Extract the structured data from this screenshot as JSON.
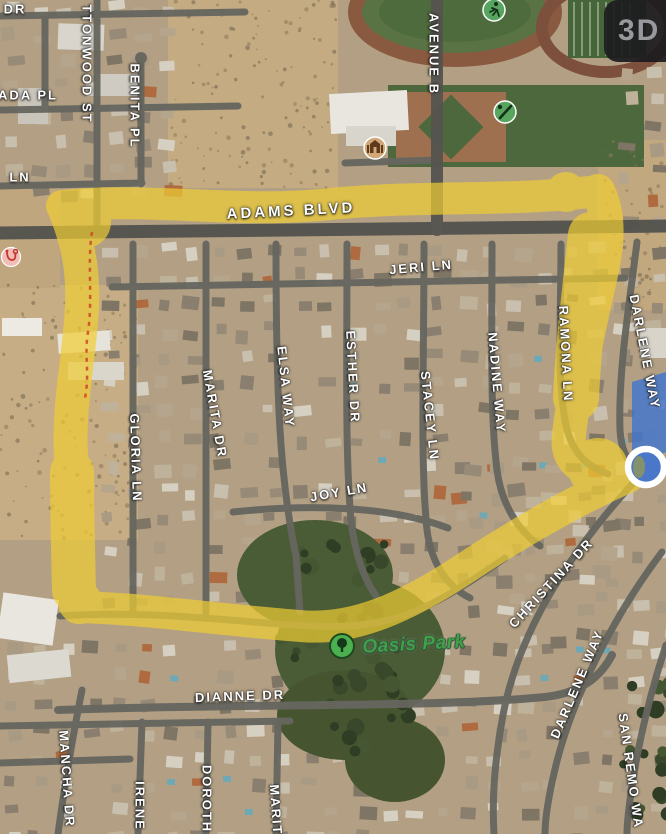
{
  "controls": {
    "map_mode_button": "3D"
  },
  "labels": {
    "partial_dr": "DR",
    "ada_pl": "ADA PL",
    "partial_ln": "LN",
    "cottonwood_st": "TTONWOOD ST",
    "benita_pl": "BENITA PL",
    "avenue_b": "AVENUE B",
    "adams_blvd": "ADAMS BLVD",
    "jeri_ln": "JERI LN",
    "gloria_ln": "GLORIA LN",
    "marita_dr": "MARITA DR",
    "elsa_way": "ELSA WAY",
    "esther_dr": "ESTHER DR",
    "stacey_ln": "STACEY LN",
    "nadine_way": "NADINE WAY",
    "ramona_ln": "RAMONA LN",
    "darlene_way_upper": "DARLENE WAY",
    "joy_ln": "JOY LN",
    "oasis_park": "Oasis Park",
    "dianne_dr": "DIANNE DR",
    "mancha_dr": "MANCHA DR",
    "irene": "IRENE",
    "dorothy": "DOROTH",
    "marita_lower": "MARIT",
    "christina_dr": "CHRISTINA DR",
    "darlene_way_lower": "DARLENE WAY",
    "san_remo_way": "SAN REMO WA"
  },
  "icons": {
    "runner": "running-person",
    "baseball": "baseball-bat-and-ball",
    "school": "school-building",
    "medical": "medical-stethoscope",
    "park_tree": "park-tree",
    "location": "current-location-dot"
  },
  "colors": {
    "route_highlight": "#f0cd33",
    "traveled_segment_blue": "#3f74d0",
    "park_label_green": "#3fa24b",
    "poi_green": "#57a55e",
    "poi_school_tan": "#d2a878",
    "poi_medical_pink": "#f2bdb6"
  }
}
